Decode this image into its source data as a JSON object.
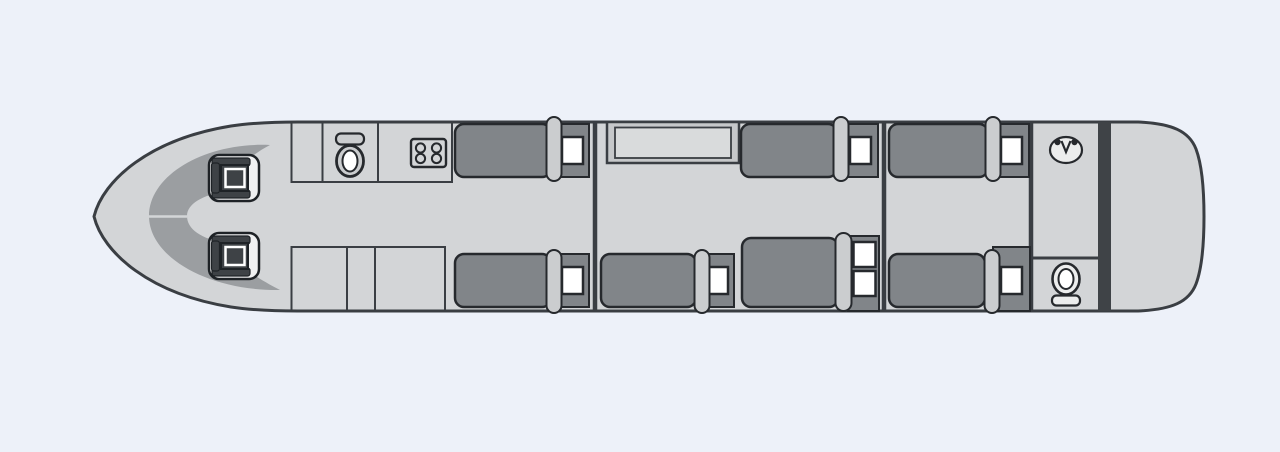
{
  "meta": {
    "description": "Top-down floor plan of a business jet cabin, nose pointing left",
    "nose_direction": "left",
    "tail_direction": "right"
  },
  "palette": {
    "background": "#edf1f9",
    "fuselage_fill": "#d3d5d7",
    "outline": "#3a3e43",
    "outline_strong": "#26292d",
    "furniture_dark": "#818589",
    "panel_shadow": "#9b9ea1",
    "armrest_light": "#cbcdcf",
    "credenza_band": "#c6c8ca",
    "credenza_inner": "#d9dbdc",
    "fixture_light": "#eceded",
    "white": "#ffffff",
    "wall_fill": "#3f4347",
    "seat_frame": "#f0f1f2",
    "seat_dark": "#3e4246"
  },
  "cockpit": {
    "pilot_seats": 2,
    "instrument_panel": "wraparound-crescent"
  },
  "forward_section": {
    "top_compartments": [
      "closet",
      "forward lavatory",
      "galley"
    ],
    "forward_lavatory_icon": "toilet-icon",
    "galley_icon": "four-burner-stove-icon",
    "bottom_compartments": [
      "cabinet",
      "cabinet",
      "cabinet"
    ]
  },
  "main_cabin": {
    "top_divans": 3,
    "bottom_divans": 4,
    "side_tables": 8,
    "credenza": 1,
    "armrests": 7
  },
  "aft_section": {
    "lavatory_rooms": [
      "washbasin room",
      "toilet room"
    ],
    "lavatory_icons": [
      "washbasin-icon",
      "toilet-icon"
    ],
    "aft_compartment": "baggage"
  }
}
